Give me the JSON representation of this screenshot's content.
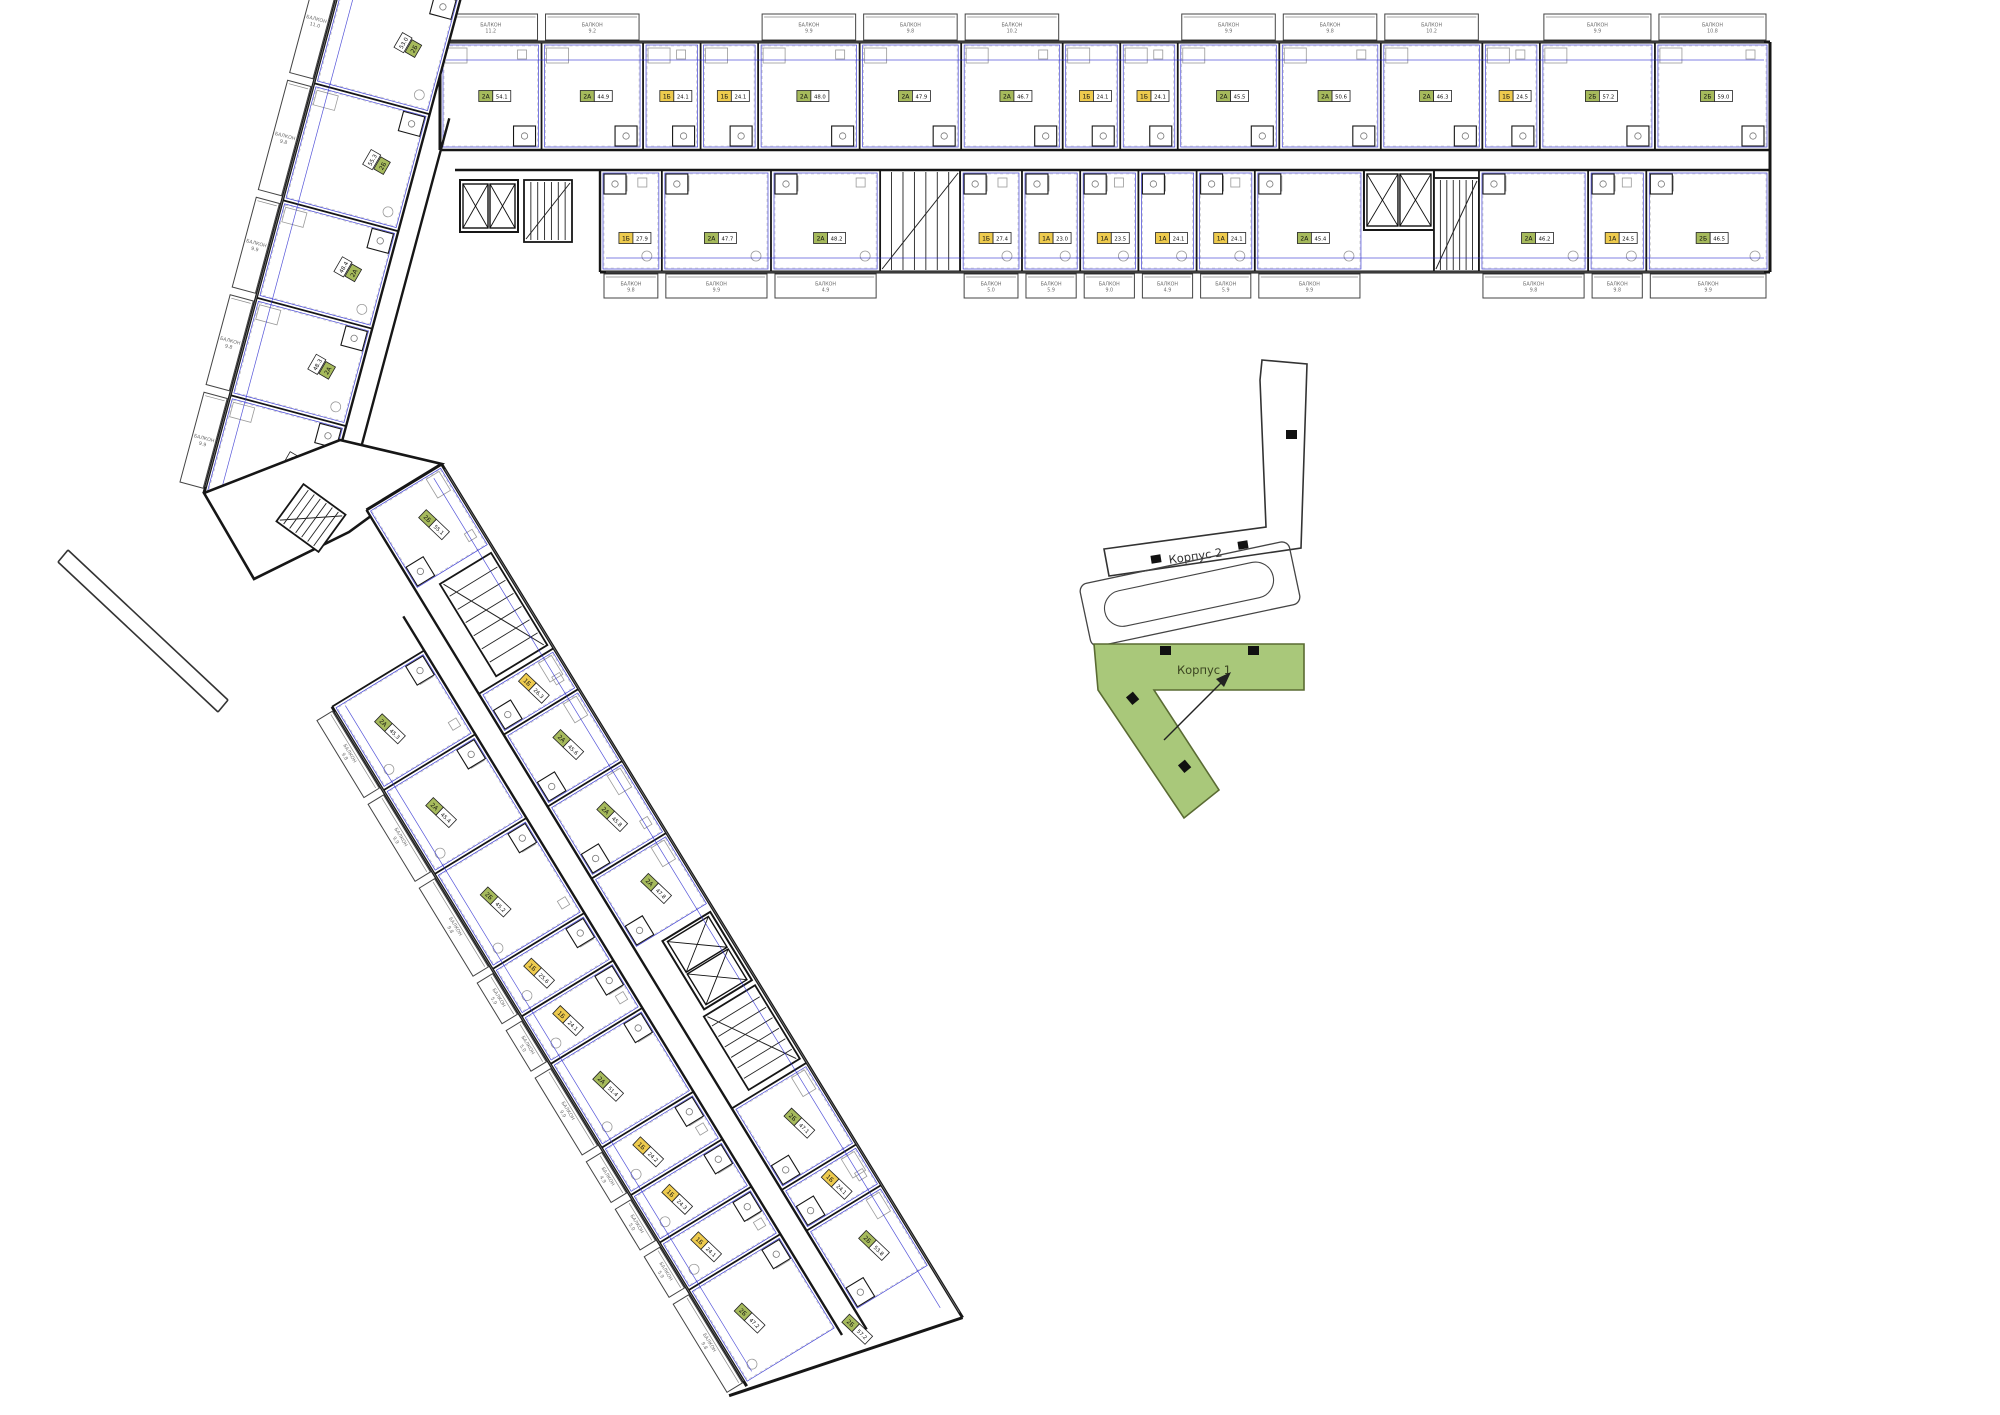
{
  "labels": {
    "korpus1": "Корпус 1",
    "korpus2": "Корпус 2",
    "balcony": "БАЛКОН"
  },
  "colors": {
    "wall": "#161616",
    "thin": "#555555",
    "furniture": "#9a9a9a",
    "blue": "#2b2bd0",
    "badge_green": "#a6ba5c",
    "badge_yellow": "#eecb4e",
    "keyplan_green": "#a9c87a",
    "keyplan_green_stroke": "#5a6b33",
    "gray_text": "#6b6b6b"
  },
  "top_wing": {
    "outer_row": [
      {
        "t": "2А",
        "a": "54.1"
      },
      {
        "t": "2А",
        "a": "44.9"
      },
      {
        "t": "1Б",
        "a": "24.1"
      },
      {
        "t": "1Б",
        "a": "24.1"
      },
      {
        "t": "2А",
        "a": "48.0"
      },
      {
        "t": "2А",
        "a": "47.9"
      },
      {
        "t": "2А",
        "a": "46.7"
      },
      {
        "t": "1Б",
        "a": "24.1"
      },
      {
        "t": "1Б",
        "a": "24.1"
      },
      {
        "t": "2А",
        "a": "45.5"
      },
      {
        "t": "2А",
        "a": "50.6"
      },
      {
        "t": "2А",
        "a": "46.3"
      },
      {
        "t": "1Б",
        "a": "24.5"
      },
      {
        "t": "2Б",
        "a": "57.2"
      },
      {
        "t": "2Б",
        "a": "59.0"
      }
    ],
    "inner_row": [
      {
        "t": "1Б",
        "a": "27.9"
      },
      {
        "t": "2А",
        "a": "47.7"
      },
      {
        "t": "2А",
        "a": "48.2"
      },
      {
        "core": "stair"
      },
      {
        "t": "1Б",
        "a": "27.4"
      },
      {
        "t": "1А",
        "a": "23.0"
      },
      {
        "t": "1А",
        "a": "23.5"
      },
      {
        "t": "1А",
        "a": "24.1"
      },
      {
        "t": "1А",
        "a": "24.1"
      },
      {
        "t": "2А",
        "a": "45.4"
      },
      {
        "core": "lift"
      },
      {
        "t": "2А",
        "a": "46.2"
      },
      {
        "t": "1А",
        "a": "24.5"
      },
      {
        "t": "2Б",
        "a": "46.5"
      }
    ]
  },
  "upper_wing": {
    "units": [
      {
        "t": "2Б",
        "a": "53.0"
      },
      {
        "t": "2Б",
        "a": "55.3"
      },
      {
        "t": "2А",
        "a": "48.4"
      },
      {
        "t": "2А",
        "a": "48.3"
      },
      {
        "t": "2А",
        "a": "45.1"
      }
    ]
  },
  "lower_wing": {
    "inner_row": [
      {
        "t": "2Б",
        "a": "55.1"
      },
      {
        "core": "stair"
      },
      {
        "t": "1Б",
        "a": "26.3"
      },
      {
        "t": "2А",
        "a": "45.6"
      },
      {
        "t": "2А",
        "a": "45.8"
      },
      {
        "t": "2А",
        "a": "47.8"
      },
      {
        "core": "lift"
      },
      {
        "t": "2Б",
        "a": "47.1"
      },
      {
        "t": "1Б",
        "a": "24.1"
      },
      {
        "t": "2Б",
        "a": "53.8"
      }
    ],
    "outer_row": [
      {
        "t": "2А",
        "a": "45.3"
      },
      {
        "t": "2А",
        "a": "45.4"
      },
      {
        "t": "2Б",
        "a": "45.2"
      },
      {
        "t": "1Б",
        "a": "25.6"
      },
      {
        "t": "1Б",
        "a": "24.1"
      },
      {
        "t": "2А",
        "a": "51.4"
      },
      {
        "t": "1Б",
        "a": "24.2"
      },
      {
        "t": "1Б",
        "a": "24.3"
      },
      {
        "t": "1Б",
        "a": "24.1"
      },
      {
        "t": "2Б",
        "a": "47.2"
      }
    ],
    "tip_unit": {
      "t": "2Б",
      "a": "57.2"
    }
  },
  "balcony_areas": {
    "top": [
      "11.2",
      "9.2",
      "9.9",
      "9.8",
      "10.2",
      "9.9",
      "9.8",
      "10.2",
      "9.9",
      "10.8"
    ],
    "bottom": [
      "9.8",
      "9.9",
      "4.9",
      "5.0",
      "5.9",
      "9.0",
      "4.9",
      "5.9",
      "9.9",
      "9.8"
    ],
    "upper_wing": [
      "11.0",
      "9.8",
      "9.9",
      "9.8",
      "9.9"
    ],
    "lower_wing": [
      "9.8",
      "9.9",
      "9.8",
      "5.9",
      "5.0",
      "9.9",
      "4.9",
      "5.0",
      "5.9",
      "9.8"
    ]
  }
}
